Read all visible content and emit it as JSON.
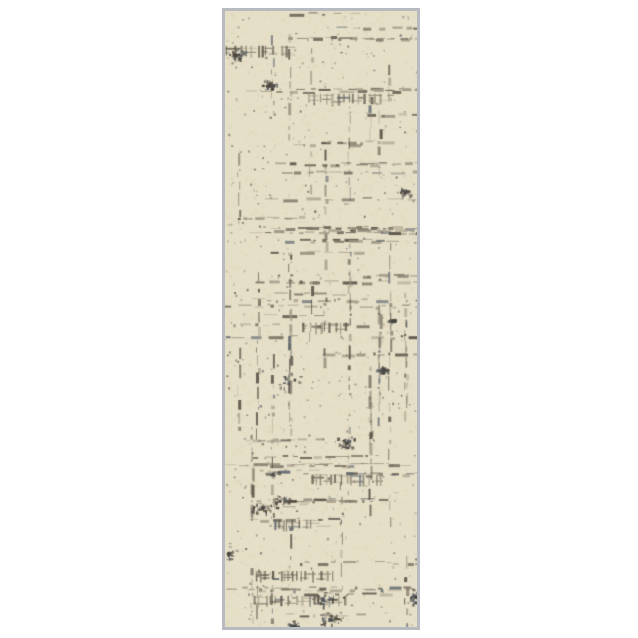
{
  "page": {
    "background_color": "#ffffff",
    "width": 638,
    "height": 638,
    "subject": "runner-rug-product-photo"
  },
  "rug": {
    "description": "vertical runner rug with distressed abstract crosshatch pattern",
    "x": 222,
    "y": 8,
    "width": 198,
    "height": 622,
    "border_width": 3,
    "border_color": "#b7babf",
    "border_inner_color": "#8f9095",
    "inner_width": 192,
    "inner_height": 616,
    "field_color": "#e6dfc7",
    "pattern": {
      "seed": 7,
      "mottle_color": "#c9bfa0",
      "mottle_count": 2500,
      "palette": [
        {
          "c": "#554e44",
          "w": 3
        },
        {
          "c": "#7a7263",
          "w": 3
        },
        {
          "c": "#a29a86",
          "w": 2
        },
        {
          "c": "#5c6570",
          "w": 1
        }
      ],
      "cluster_dark": "#4a443c",
      "cluster_blue": "#525a64",
      "h_lines": 48,
      "v_cols": 13,
      "ladders": 7,
      "clusters": 16,
      "scatter": 500
    }
  }
}
